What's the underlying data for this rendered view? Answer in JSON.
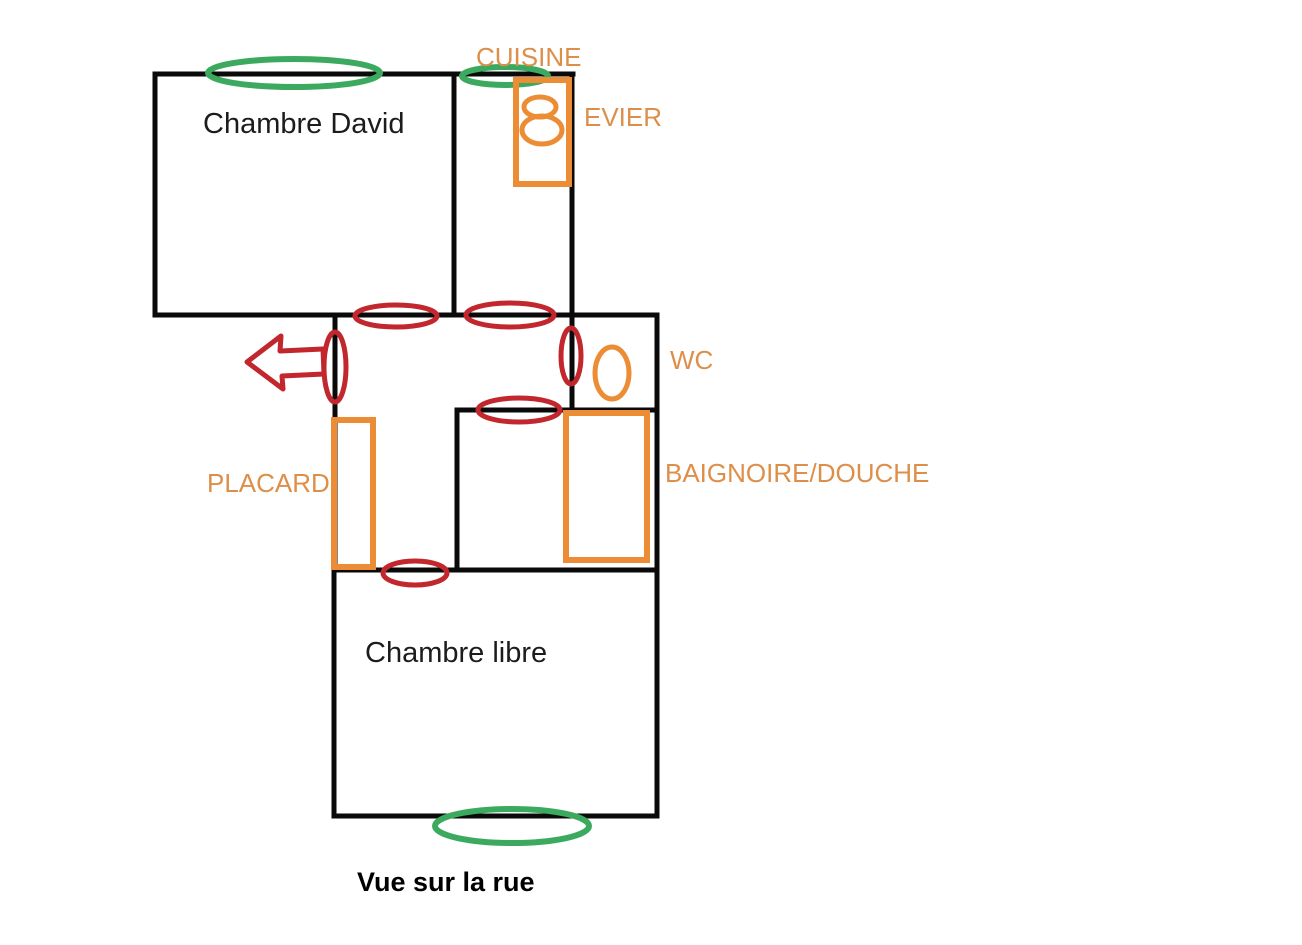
{
  "colors": {
    "wall": "#0a0a0a",
    "door": "#c1272d",
    "window": "#3caa5e",
    "fixture": "#ec8c35",
    "label": "#dd8f4a",
    "room_text": "#1c1c1c",
    "street_text": "#000000"
  },
  "rooms": {
    "chambre_david": "Chambre David",
    "cuisine": "CUISINE",
    "wc": "WC",
    "chambre_libre": "Chambre libre"
  },
  "fixtures": {
    "evier": "EVIER",
    "baignoire": "BAIGNOIRE/DOUCHE",
    "placard": "PLACARD"
  },
  "caption": {
    "street_view": "Vue sur la rue"
  }
}
